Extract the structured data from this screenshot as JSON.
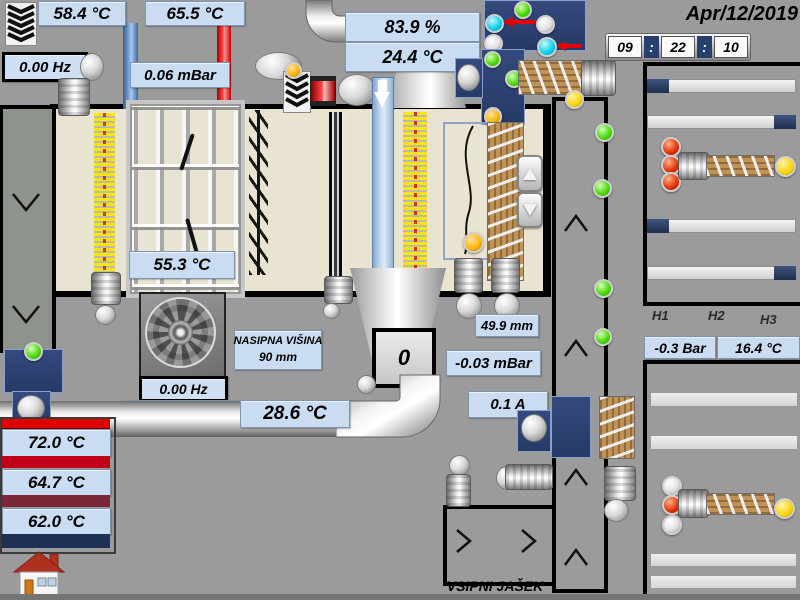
{
  "header": {
    "date": "Apr/12/2019",
    "time": {
      "hours": "09",
      "minutes": "22",
      "seconds": "10",
      "separator": ":"
    }
  },
  "readouts": {
    "exhaust_fan_freq": "0.00 Hz",
    "flue_temp_left": "58.4 °C",
    "flue_temp_right": "65.5 °C",
    "chamber_pressure": "0.06 mBar",
    "top_percent": "83.9 %",
    "top_temp": "24.4 °C",
    "grate_temp": "55.3 °C",
    "fill_height_title": "NASIPNA VIŠINA",
    "fill_height_value": "90 mm",
    "hopper_counter": "0",
    "gap_distance": "49.9 mm",
    "underpressure": "-0.03 mBar",
    "motor_current": "0.1 A",
    "main_fan_freq": "0.00 Hz",
    "main_fan_percent": "40.1 %",
    "return_pipe_temp": "28.6 °C",
    "tank_temp_top": "72.0 °C",
    "tank_temp_middle": "64.7 °C",
    "tank_temp_bottom": "62.0 °C",
    "silo_pressure": "-0.3 Bar",
    "silo_temp": "16.4 °C"
  },
  "texts": {
    "h1": "H1",
    "h2": "H2",
    "h3": "H3",
    "intake_shaft_label": "VSIPNI JAŠEK"
  },
  "colors": {
    "background": "#9b9b9b",
    "label_bg": "#c9dcf2",
    "panel_navy": "#2c4270",
    "pipe_blue": "#4f81bd",
    "pipe_red": "#ec0000",
    "status_green": "#46d800",
    "status_cyan": "#00cfe8",
    "status_red": "#e03000",
    "status_orange": "#ffb400",
    "status_yellow": "#ffd400",
    "heater_yellow": "#ffe600",
    "tank_bar_red_bright": "#e00000",
    "tank_bar_red": "#c00018",
    "tank_bar_maroon": "#7a2838",
    "tank_bar_navy": "#1e3054",
    "chamber_beige": "#e9e4d1"
  }
}
